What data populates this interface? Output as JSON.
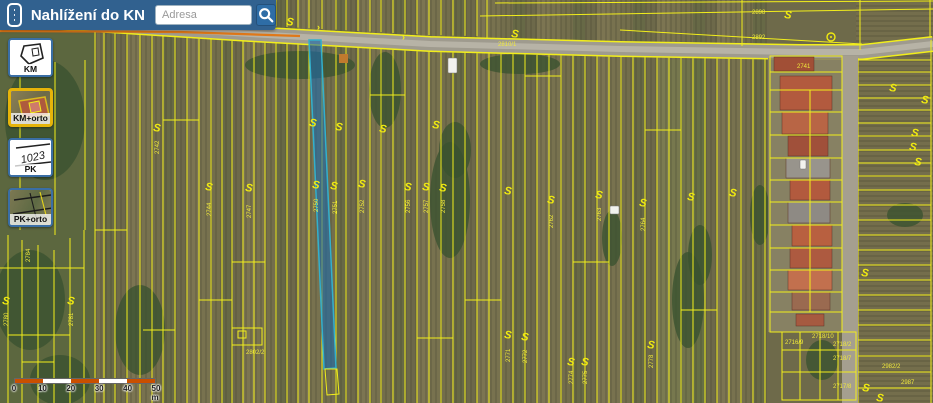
{
  "header": {
    "title": "Nahlížení do KN",
    "search_placeholder": "Adresa",
    "bg_color": "#31618f"
  },
  "sidebar": {
    "buttons": [
      {
        "id": "km",
        "label": "KM",
        "selected": false
      },
      {
        "id": "km-orto",
        "label": "KM+orto",
        "selected": true
      },
      {
        "id": "pk",
        "label": "PK",
        "selected": false
      },
      {
        "id": "pk-orto",
        "label": "PK+orto",
        "selected": false
      }
    ],
    "pk_sketch_text": "1023"
  },
  "scalebar": {
    "labels": [
      "0",
      "10",
      "20",
      "30",
      "40",
      "50"
    ],
    "unit": "m",
    "segment_colors": [
      "#c94f00",
      "#ffffff",
      "#c94f00",
      "#ffffff",
      "#c94f00"
    ]
  },
  "map": {
    "colors": {
      "base": "#6e6a4a",
      "yellow": "#f2ee1b",
      "label": "#f0e93c",
      "orange": "#e07818",
      "tree": "#3a5230",
      "road_outer": "#9f9b8e",
      "road_inner": "#b7b3a6",
      "left_zone": "#5c673f",
      "right_zone": "#746e4c",
      "grass_zone": "#6d7a49",
      "yard": "#8a8466",
      "path": "#a59f8f",
      "sel_fill": "#1d6bab",
      "sel_stroke": "#33b0cc"
    },
    "palette": [
      "#77714e",
      "#6b684a",
      "#827a54",
      "#5f6742",
      "#8a805a"
    ],
    "road": {
      "points": [
        [
          60,
          22
        ],
        [
          250,
          34
        ],
        [
          430,
          44
        ],
        [
          620,
          49
        ],
        [
          800,
          52
        ],
        [
          862,
          52
        ],
        [
          933,
          44
        ]
      ]
    },
    "orange_line": [
      [
        0,
        31
      ],
      [
        180,
        32
      ],
      [
        300,
        36
      ]
    ],
    "chevrons": [
      [
        317,
        30
      ],
      [
        402,
        40
      ]
    ],
    "strip_xs": [
      95,
      104,
      115,
      127,
      140,
      152,
      163,
      175,
      187,
      199,
      211,
      222,
      232,
      243,
      254,
      265,
      276,
      287,
      298,
      309,
      322,
      336,
      346,
      358,
      370,
      381,
      393,
      405,
      417,
      429,
      441,
      453,
      465,
      477,
      489,
      501,
      513,
      525,
      537,
      549,
      561,
      573,
      585,
      597,
      609,
      621,
      633,
      645,
      657,
      669,
      681,
      693,
      705,
      717,
      729,
      741,
      753,
      765
    ],
    "left_v_lines": [
      [
        8,
        235,
        403
      ],
      [
        22,
        240,
        403
      ],
      [
        38,
        245,
        403
      ],
      [
        54,
        250,
        403
      ],
      [
        70,
        238,
        403
      ],
      [
        84,
        230,
        403
      ],
      [
        20,
        60,
        230
      ],
      [
        55,
        62,
        235
      ],
      [
        85,
        60,
        230
      ]
    ],
    "left_h_lines": [
      [
        0,
        84,
        268
      ],
      [
        8,
        70,
        335
      ],
      [
        22,
        54,
        362
      ]
    ],
    "h_segments": [
      [
        95,
        127,
        230
      ],
      [
        163,
        199,
        120
      ],
      [
        232,
        265,
        262
      ],
      [
        370,
        405,
        95
      ],
      [
        465,
        501,
        300
      ],
      [
        573,
        609,
        262
      ],
      [
        143,
        175,
        330
      ],
      [
        645,
        681,
        130
      ],
      [
        525,
        561,
        76
      ],
      [
        681,
        717,
        310
      ],
      [
        199,
        232,
        300
      ],
      [
        417,
        453,
        338
      ]
    ],
    "top_lines": [
      [
        495,
        3,
        933,
        1
      ],
      [
        480,
        16,
        933,
        9
      ],
      [
        620,
        30,
        862,
        44
      ],
      [
        487,
        0,
        487,
        38
      ],
      [
        742,
        0,
        742,
        46
      ],
      [
        930,
        0,
        930,
        38
      ],
      [
        860,
        0,
        860,
        50
      ]
    ],
    "right": {
      "x1": 858,
      "x2": 931,
      "ys": [
        60,
        72,
        85,
        98,
        110,
        123,
        136,
        150,
        163,
        176,
        190,
        205,
        220,
        235,
        250,
        265,
        280,
        295,
        310,
        325,
        340,
        356,
        372,
        388
      ]
    },
    "buildings": {
      "yard": [
        768,
        58,
        74,
        274
      ],
      "path": [
        842,
        56,
        16,
        347
      ],
      "outline": [
        770,
        56,
        72,
        276
      ],
      "grid_ys": [
        72,
        90,
        112,
        135,
        158,
        180,
        202,
        225,
        248,
        270,
        292,
        312
      ],
      "v_line": [
        810,
        90,
        312
      ],
      "roofs": [
        [
          774,
          57,
          40,
          14,
          "#a14f36"
        ],
        [
          780,
          76,
          52,
          34,
          "#b25a3e"
        ],
        [
          782,
          112,
          46,
          22,
          "#b86545"
        ],
        [
          788,
          136,
          40,
          20,
          "#a0503a"
        ],
        [
          786,
          158,
          44,
          20,
          "#98948c"
        ],
        [
          790,
          180,
          40,
          20,
          "#b25a3e"
        ],
        [
          788,
          202,
          42,
          21,
          "#8e8a84"
        ],
        [
          792,
          225,
          40,
          21,
          "#b86040"
        ],
        [
          790,
          248,
          42,
          20,
          "#ad5a40"
        ],
        [
          788,
          270,
          44,
          20,
          "#c2704e"
        ],
        [
          792,
          292,
          38,
          18,
          "#9a6a50"
        ],
        [
          796,
          314,
          28,
          12,
          "#a65a40"
        ]
      ],
      "bottom_cluster": {
        "rect": [
          782,
          332,
          74,
          68
        ],
        "v_xs": [
          800,
          820,
          838
        ],
        "h_ys": [
          350,
          372
        ]
      }
    },
    "blue_parcel": {
      "points": [
        [
          309,
          40
        ],
        [
          321,
          40
        ],
        [
          336,
          368
        ],
        [
          324,
          369
        ]
      ],
      "ext": [
        [
          325,
          369
        ],
        [
          337,
          369
        ],
        [
          339,
          394
        ],
        [
          327,
          395
        ]
      ]
    },
    "small_parcel": {
      "rect": [
        232,
        328,
        30,
        17
      ],
      "inner": [
        238,
        331,
        8,
        7
      ]
    },
    "trees": [
      [
        45,
        120,
        40,
        60
      ],
      [
        30,
        300,
        35,
        50
      ],
      [
        60,
        380,
        30,
        25
      ],
      [
        140,
        330,
        25,
        45
      ],
      [
        300,
        65,
        55,
        14
      ],
      [
        385,
        90,
        16,
        38
      ],
      [
        450,
        200,
        20,
        58
      ],
      [
        455,
        150,
        16,
        28
      ],
      [
        520,
        64,
        40,
        10
      ],
      [
        612,
        238,
        10,
        28
      ],
      [
        688,
        300,
        16,
        48
      ],
      [
        700,
        255,
        12,
        30
      ],
      [
        760,
        215,
        10,
        30
      ],
      [
        822,
        360,
        16,
        20
      ],
      [
        905,
        215,
        18,
        12
      ],
      [
        880,
        50,
        25,
        8
      ]
    ],
    "cars": [
      [
        448,
        58,
        9,
        15
      ],
      [
        610,
        206,
        9,
        8
      ],
      [
        800,
        160,
        6,
        9
      ]
    ],
    "shed": [
      339,
      54,
      9,
      9
    ],
    "s_markers": [
      [
        287,
        17
      ],
      [
        512,
        29
      ],
      [
        785,
        10
      ],
      [
        154,
        123
      ],
      [
        310,
        118
      ],
      [
        336,
        122
      ],
      [
        380,
        124
      ],
      [
        433,
        120
      ],
      [
        206,
        182
      ],
      [
        246,
        183
      ],
      [
        313,
        180
      ],
      [
        331,
        181
      ],
      [
        359,
        179
      ],
      [
        405,
        182
      ],
      [
        423,
        182
      ],
      [
        440,
        183
      ],
      [
        505,
        186
      ],
      [
        548,
        195
      ],
      [
        596,
        190
      ],
      [
        640,
        198
      ],
      [
        688,
        192
      ],
      [
        730,
        188
      ],
      [
        505,
        330
      ],
      [
        522,
        332
      ],
      [
        568,
        357
      ],
      [
        582,
        357
      ],
      [
        648,
        340
      ],
      [
        3,
        296
      ],
      [
        68,
        296
      ],
      [
        890,
        83
      ],
      [
        922,
        95
      ],
      [
        912,
        128
      ],
      [
        910,
        142
      ],
      [
        915,
        157
      ],
      [
        862,
        268
      ],
      [
        863,
        383
      ],
      [
        877,
        393
      ]
    ],
    "circle_markers": [
      [
        831,
        37
      ]
    ],
    "labels": [
      {
        "t": "2810/1",
        "x": 498,
        "y": 46,
        "r": 0
      },
      {
        "t": "2898",
        "x": 752,
        "y": 14,
        "r": 0
      },
      {
        "t": "2892",
        "x": 752,
        "y": 39,
        "r": 0
      },
      {
        "t": "2741",
        "x": 797,
        "y": 68,
        "r": 0
      },
      {
        "t": "2716/9",
        "x": 785,
        "y": 344,
        "r": 0
      },
      {
        "t": "2718/10",
        "x": 812,
        "y": 338,
        "r": 0
      },
      {
        "t": "2718/2",
        "x": 833,
        "y": 346,
        "r": 0
      },
      {
        "t": "2718/7",
        "x": 833,
        "y": 360,
        "r": 0
      },
      {
        "t": "2717/8",
        "x": 833,
        "y": 388,
        "r": 0
      },
      {
        "t": "2802/2",
        "x": 246,
        "y": 354,
        "r": 0
      },
      {
        "t": "2982/2",
        "x": 882,
        "y": 368,
        "r": 0
      },
      {
        "t": "2987",
        "x": 901,
        "y": 384,
        "r": 0
      },
      {
        "t": "2744",
        "x": 211,
        "y": 216,
        "r": -90
      },
      {
        "t": "2747",
        "x": 251,
        "y": 218,
        "r": -90
      },
      {
        "t": "2750",
        "x": 318,
        "y": 212,
        "r": -90
      },
      {
        "t": "2751",
        "x": 337,
        "y": 214,
        "r": -90
      },
      {
        "t": "2752",
        "x": 364,
        "y": 213,
        "r": -90
      },
      {
        "t": "2756",
        "x": 410,
        "y": 213,
        "r": -90
      },
      {
        "t": "2757",
        "x": 428,
        "y": 213,
        "r": -90
      },
      {
        "t": "2758",
        "x": 445,
        "y": 213,
        "r": -90
      },
      {
        "t": "2762",
        "x": 553,
        "y": 228,
        "r": -90
      },
      {
        "t": "2763",
        "x": 601,
        "y": 221,
        "r": -90
      },
      {
        "t": "2764",
        "x": 645,
        "y": 231,
        "r": -90
      },
      {
        "t": "2771",
        "x": 510,
        "y": 362,
        "r": -90
      },
      {
        "t": "2772",
        "x": 527,
        "y": 363,
        "r": -90
      },
      {
        "t": "2774",
        "x": 573,
        "y": 384,
        "r": -90
      },
      {
        "t": "2775",
        "x": 587,
        "y": 384,
        "r": -90
      },
      {
        "t": "2778",
        "x": 653,
        "y": 368,
        "r": -90
      },
      {
        "t": "2780",
        "x": 8,
        "y": 326,
        "r": -90
      },
      {
        "t": "2781",
        "x": 73,
        "y": 326,
        "r": -90
      },
      {
        "t": "2742",
        "x": 159,
        "y": 154,
        "r": -90
      },
      {
        "t": "2784",
        "x": 30,
        "y": 262,
        "r": -90
      }
    ]
  }
}
